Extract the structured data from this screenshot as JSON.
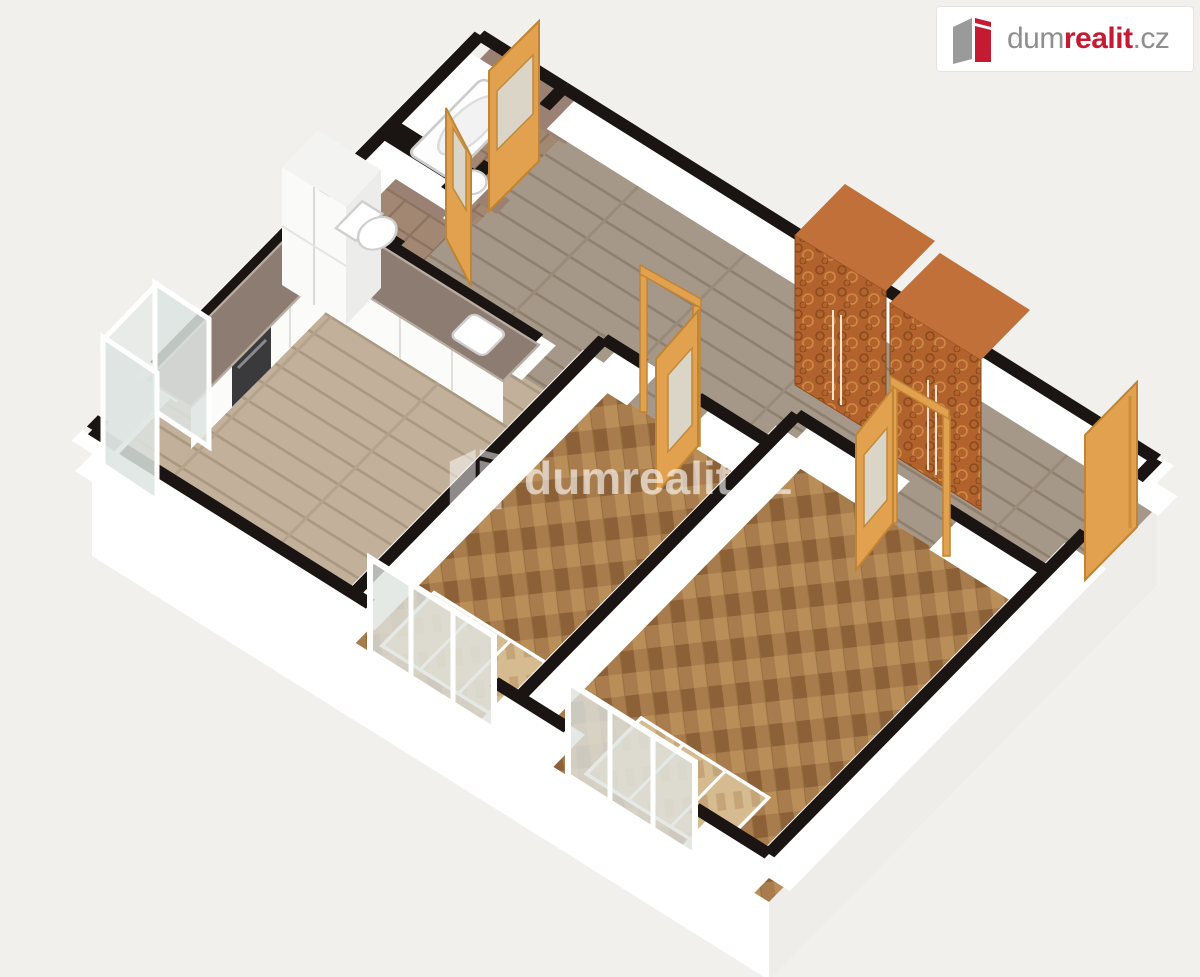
{
  "page": {
    "background_color": "#f2f0ed"
  },
  "logo": {
    "text_prefix": "dum",
    "text_accent": "realit",
    "text_suffix": ".cz",
    "accent_color": "#c41b33",
    "muted_color": "#8e8e8e"
  },
  "watermark": {
    "text": "dumrealit.cz"
  },
  "floorplan": {
    "colors": {
      "wall_outline": "#1a1512",
      "wall_face": "#ffffff",
      "bathroom_tile_wall": "#9b8173",
      "bathroom_tile_floor": "#a28873",
      "hallway_floor": "#a69888",
      "kitchen_floor": "#c2b09a",
      "parquet_floor": "#a87c4c",
      "door_orange": "#e2a14f",
      "wardrobe_wood": "#b2622c",
      "counter_top": "#8d7c71",
      "exterior_wall": "#fbfbfa"
    }
  }
}
